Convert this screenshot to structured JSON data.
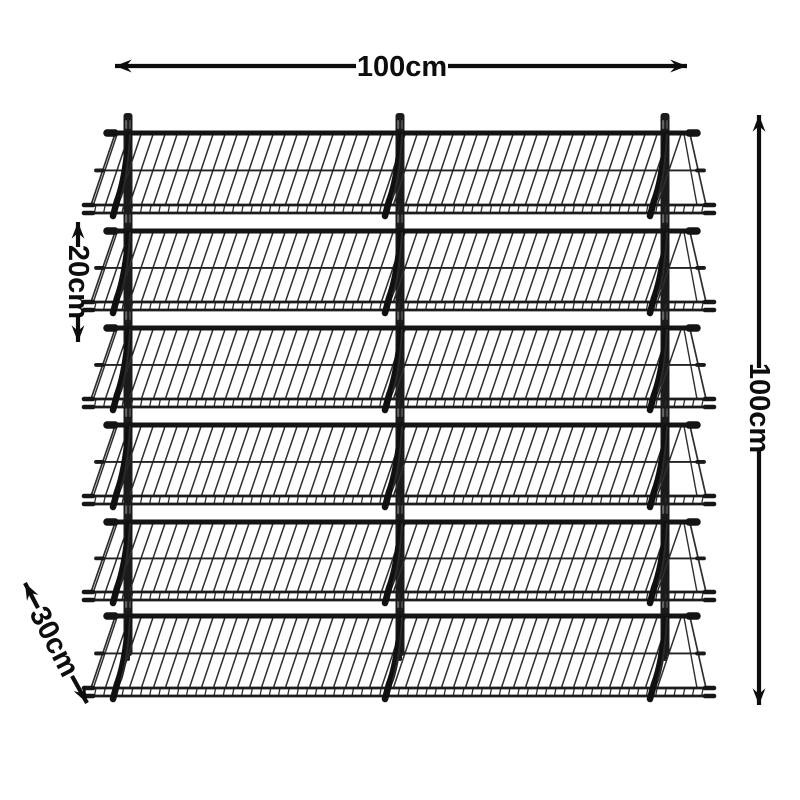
{
  "product": {
    "description": "Black wire wall-mounted tilted display shelving unit",
    "shelf_count": 6,
    "wall_rail_count": 3
  },
  "dimensions": {
    "width": "100cm",
    "height": "100cm",
    "shelf_spacing": "20cm",
    "shelf_depth": "30cm"
  },
  "colors": {
    "background": "#ffffff",
    "annotation": "#0d0d0d",
    "rail_metal": "#1b1b1b",
    "bar_metal": "#141414",
    "wire_metal": "#2e2e2e",
    "bracket_metal": "#101010",
    "slot_highlight": "#6e6e6e"
  }
}
